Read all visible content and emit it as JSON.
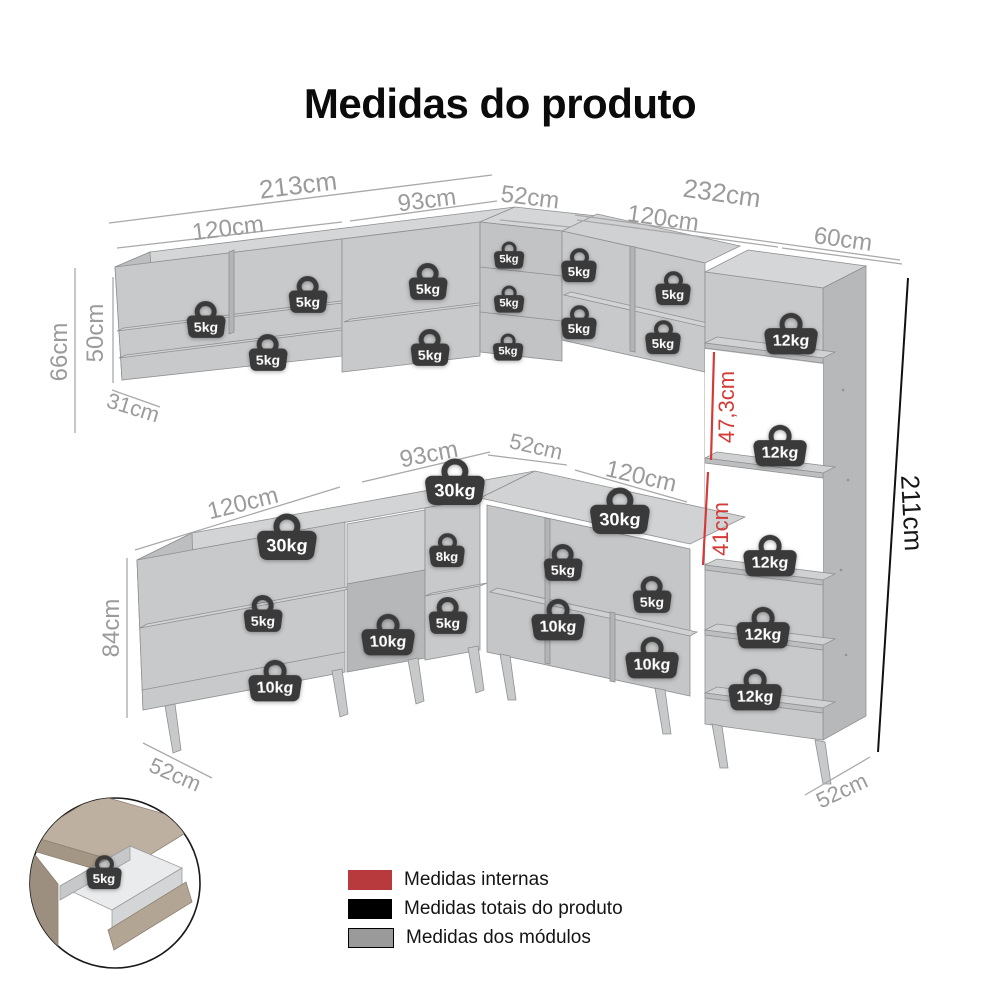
{
  "title": "Medidas do produto",
  "colors": {
    "module_gray": "#9b9b9b",
    "total_black": "#000000",
    "internal_red": "#d43b38",
    "legend_red": "#b93a3d",
    "legend_gray": "#9a9a9a"
  },
  "measurements": {
    "wall_total_left": "213cm",
    "wall_left_module": "120cm",
    "wall_mid_module": "93cm",
    "wall_corner_module": "52cm",
    "wall_total_right": "232cm",
    "wall_right_module": "120cm",
    "tall_cabinet_width": "60cm",
    "wall_height_total": "66cm",
    "wall_height_module": "50cm",
    "wall_depth": "31cm",
    "base_height": "84cm",
    "base_left_module": "120cm",
    "base_mid_module": "93cm",
    "base_corner_module": "52cm",
    "base_right_module": "120cm",
    "tall_internal_upper": "47,3cm",
    "tall_internal_lower": "41cm",
    "total_height": "211cm",
    "base_depth_left": "52cm",
    "base_depth_right": "52cm"
  },
  "weights": [
    "5kg",
    "5kg",
    "5kg",
    "5kg",
    "5kg",
    "5kg",
    "5kg",
    "5kg",
    "5kg",
    "5kg",
    "5kg",
    "5kg",
    "12kg",
    "12kg",
    "12kg",
    "12kg",
    "12kg",
    "30kg",
    "30kg",
    "30kg",
    "5kg",
    "10kg",
    "8kg",
    "5kg",
    "10kg",
    "5kg",
    "5kg",
    "10kg",
    "10kg",
    "5kg"
  ],
  "legend": {
    "items": [
      {
        "label": "Medidas internas",
        "swatch": "red"
      },
      {
        "label": "Medidas totais do produto",
        "swatch": "black"
      },
      {
        "label": "Medidas dos módulos",
        "swatch": "gray"
      }
    ]
  }
}
